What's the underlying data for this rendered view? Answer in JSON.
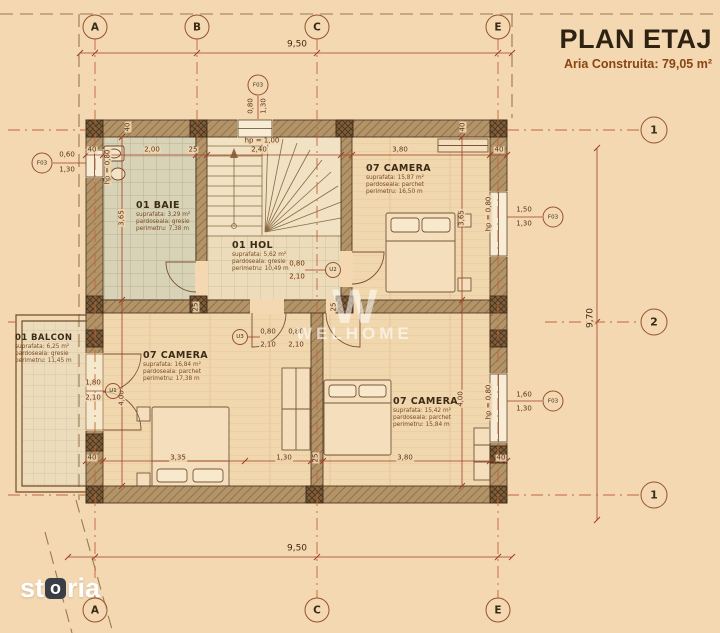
{
  "header": {
    "title": "PLAN ETAJ",
    "subtitle": "Aria Construita: 79,05 m²"
  },
  "watermark": {
    "initial": "W",
    "name": "WELHOME"
  },
  "brand": {
    "pre": "st",
    "o": "o",
    "post": "ria"
  },
  "rooms": [
    {
      "id": "baie",
      "name": "01 BAIE",
      "area": "suprafata: 3,29 m²",
      "floor": "pardoseala: gresie",
      "perimeter": "perimetru: 7,38 m"
    },
    {
      "id": "hol",
      "name": "01 HOL",
      "area": "suprafata: 5,62 m²",
      "floor": "pardoseala: gresie",
      "perimeter": "perimetru: 10,49 m"
    },
    {
      "id": "camera-ne",
      "name": "07 CAMERA",
      "area": "suprafata: 15,87 m²",
      "floor": "pardoseala: parchet",
      "perimeter": "perimetru: 16,50 m"
    },
    {
      "id": "camera-sw",
      "name": "07 CAMERA",
      "area": "suprafata: 16,84 m²",
      "floor": "pardoseala: parchet",
      "perimeter": "perimetru: 17,38 m"
    },
    {
      "id": "camera-se",
      "name": "07 CAMERA",
      "area": "suprafata: 15,42 m²",
      "floor": "pardoseala: parchet",
      "perimeter": "perimetru: 15,84 m"
    },
    {
      "id": "balcon",
      "name": "01 BALCON",
      "area": "suprafata: 6,25 m²",
      "floor": "pardoseala: gresie",
      "perimeter": "perimetru: 11,45 m"
    }
  ],
  "plan": {
    "bubbles": [
      {
        "label": "A",
        "x": 95,
        "y": 27,
        "kind": "axis"
      },
      {
        "label": "B",
        "x": 197,
        "y": 27,
        "kind": "axis"
      },
      {
        "label": "C",
        "x": 317,
        "y": 27,
        "kind": "axis"
      },
      {
        "label": "E",
        "x": 498,
        "y": 27,
        "kind": "axis"
      },
      {
        "label": "A",
        "x": 95,
        "y": 610,
        "kind": "axis"
      },
      {
        "label": "C",
        "x": 317,
        "y": 610,
        "kind": "axis"
      },
      {
        "label": "E",
        "x": 498,
        "y": 610,
        "kind": "axis"
      },
      {
        "label": "1",
        "x": 654,
        "y": 130,
        "kind": "level"
      },
      {
        "label": "2",
        "x": 654,
        "y": 322,
        "kind": "level"
      },
      {
        "label": "1",
        "x": 654,
        "y": 495,
        "kind": "level"
      },
      {
        "label": "F03",
        "x": 42,
        "y": 163,
        "kind": "f03"
      },
      {
        "label": "F03",
        "x": 258,
        "y": 85,
        "kind": "f03"
      },
      {
        "label": "F03",
        "x": 553,
        "y": 217,
        "kind": "f03"
      },
      {
        "label": "F03",
        "x": 553,
        "y": 401,
        "kind": "f03"
      },
      {
        "label": "U1",
        "x": 113,
        "y": 391,
        "kind": "door"
      },
      {
        "label": "U2",
        "x": 333,
        "y": 270,
        "kind": "door"
      },
      {
        "label": "U3",
        "x": 240,
        "y": 337,
        "kind": "door"
      }
    ],
    "dimension_labels": [
      {
        "v": "9,50",
        "x": 297,
        "y": 45,
        "main": true
      },
      {
        "v": "9,50",
        "x": 297,
        "y": 549,
        "main": true
      },
      {
        "v": "9,70",
        "x": 591,
        "y": 318,
        "rot": true,
        "main": true
      },
      {
        "v": "40",
        "x": 92,
        "y": 150
      },
      {
        "v": "2,00",
        "x": 152,
        "y": 150
      },
      {
        "v": "25",
        "x": 193,
        "y": 150
      },
      {
        "v": "2,40",
        "x": 259,
        "y": 150
      },
      {
        "v": "3,80",
        "x": 400,
        "y": 150
      },
      {
        "v": "40",
        "x": 499,
        "y": 150
      },
      {
        "v": "hp = 1,00",
        "x": 262,
        "y": 141
      },
      {
        "v": "40",
        "x": 128,
        "y": 127,
        "rot": true
      },
      {
        "v": "40",
        "x": 463,
        "y": 127,
        "rot": true
      },
      {
        "v": "0,60",
        "x": 67,
        "y": 155
      },
      {
        "v": "1,30",
        "x": 67,
        "y": 170
      },
      {
        "v": "hp = 0,80",
        "x": 108,
        "y": 167,
        "rot": true
      },
      {
        "v": "3,65",
        "x": 122,
        "y": 218,
        "rot": true
      },
      {
        "v": "4,00",
        "x": 122,
        "y": 398,
        "rot": true
      },
      {
        "v": "1,80",
        "x": 93,
        "y": 383
      },
      {
        "v": "2,10",
        "x": 93,
        "y": 398
      },
      {
        "v": "0,80",
        "x": 251,
        "y": 106,
        "rot": true
      },
      {
        "v": "1,30",
        "x": 264,
        "y": 106,
        "rot": true
      },
      {
        "v": "3,65",
        "x": 462,
        "y": 218,
        "rot": true
      },
      {
        "v": "hp = 0,80",
        "x": 489,
        "y": 214,
        "rot": true
      },
      {
        "v": "1,50",
        "x": 524,
        "y": 210
      },
      {
        "v": "1,30",
        "x": 524,
        "y": 224
      },
      {
        "v": "4,00",
        "x": 461,
        "y": 399,
        "rot": true
      },
      {
        "v": "hp = 0,80",
        "x": 489,
        "y": 402,
        "rot": true
      },
      {
        "v": "1,60",
        "x": 524,
        "y": 395
      },
      {
        "v": "1,30",
        "x": 524,
        "y": 409
      },
      {
        "v": "0,80",
        "x": 297,
        "y": 264
      },
      {
        "v": "2,10",
        "x": 297,
        "y": 277
      },
      {
        "v": "0,80",
        "x": 268,
        "y": 332
      },
      {
        "v": "2,10",
        "x": 268,
        "y": 345
      },
      {
        "v": "0,80",
        "x": 296,
        "y": 332
      },
      {
        "v": "2,10",
        "x": 296,
        "y": 345
      },
      {
        "v": "25",
        "x": 196,
        "y": 307,
        "rot": true
      },
      {
        "v": "25",
        "x": 334,
        "y": 307,
        "rot": true
      },
      {
        "v": "40",
        "x": 92,
        "y": 458
      },
      {
        "v": "3,35",
        "x": 178,
        "y": 458
      },
      {
        "v": "1,30",
        "x": 284,
        "y": 458
      },
      {
        "v": "25",
        "x": 316,
        "y": 458,
        "rot": true
      },
      {
        "v": "3,80",
        "x": 405,
        "y": 458
      },
      {
        "v": "40",
        "x": 501,
        "y": 458
      }
    ]
  },
  "colors": {
    "paper": "#f3d8b2",
    "dimension_line": "#a33d22",
    "grid_line": "#c0663e",
    "wall_outline": "#4f3a25",
    "title": "#2e2212",
    "subtitle": "#8a4513"
  }
}
